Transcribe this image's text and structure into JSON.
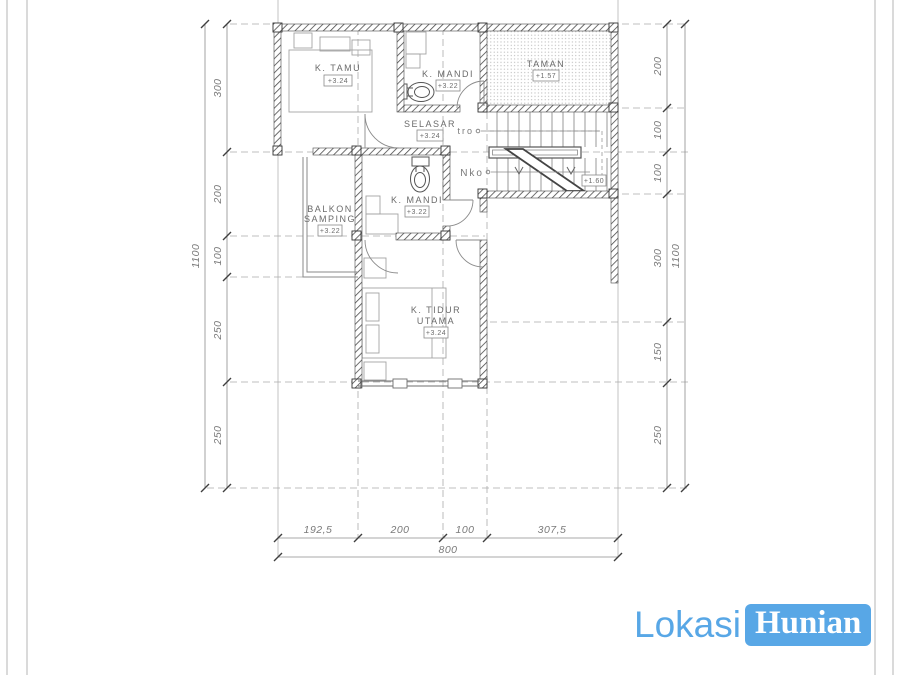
{
  "rooms": {
    "k_tamu": {
      "label": "K. TAMU",
      "elev": "+3.24"
    },
    "k_mandi_atas": {
      "label": "K. MANDI",
      "elev": "+3.22"
    },
    "taman": {
      "label": "TAMAN",
      "elev": "+1.57"
    },
    "selasar": {
      "label": "SELASAR",
      "elev": "+3.24"
    },
    "k_mandi": {
      "label": "K. MANDI",
      "elev": "+3.22"
    },
    "balkon": {
      "line1": "BALKON",
      "line2": "SAMPING",
      "elev": "+3.22"
    },
    "k_tidur": {
      "line1": "K. TIDUR",
      "line2": "UTAMA",
      "elev": "+3.24"
    }
  },
  "stairs": {
    "note_tro": "tro",
    "note_nko": "Nko",
    "landing_elev": "+1.60"
  },
  "dimensions": {
    "left": {
      "segments": [
        "300",
        "200",
        "100",
        "250",
        "250"
      ],
      "total": "1100"
    },
    "right": {
      "segments": [
        "200",
        "100",
        "100",
        "300",
        "150",
        "250"
      ],
      "total": "1100"
    },
    "bottom": {
      "segments": [
        "192,5",
        "200",
        "100",
        "307,5"
      ],
      "total": "800"
    }
  },
  "logo": {
    "word1": "Lokasi",
    "word2": "Hunian",
    "accent_color": "#58a7e6"
  }
}
